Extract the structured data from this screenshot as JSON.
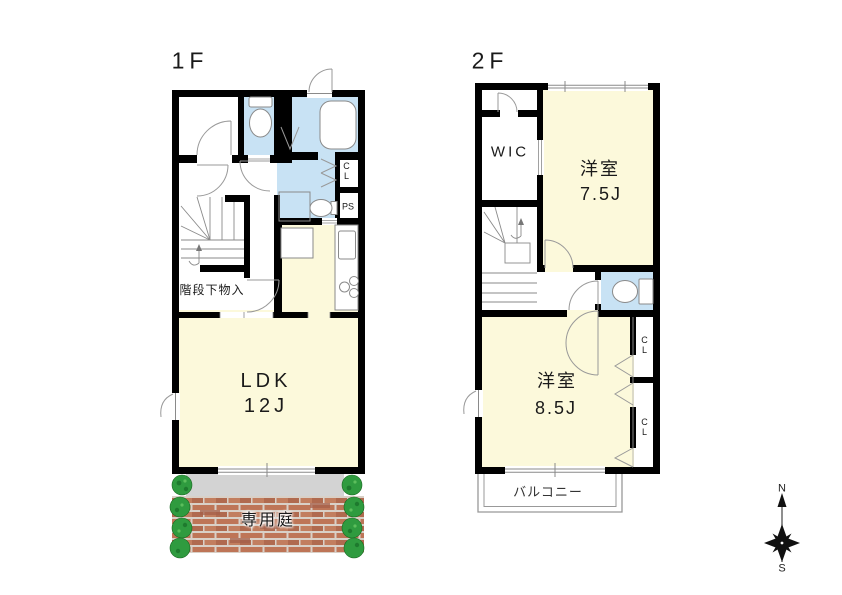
{
  "floor1": {
    "label": "1F",
    "ldk_name": "LDK",
    "ldk_size": "12J",
    "storage": "階段下物入",
    "closet": "CL",
    "pipe_space": "PS",
    "garden": "専用庭"
  },
  "floor2": {
    "label": "2F",
    "wic": "WIC",
    "bedroom1_name": "洋室",
    "bedroom1_size": "7.5J",
    "bedroom2_name": "洋室",
    "bedroom2_size": "8.5J",
    "closet1": "CL",
    "closet2": "CL",
    "balcony": "バルコニー"
  },
  "compass": {
    "north": "N",
    "south": "S"
  },
  "colors": {
    "wall": "#000000",
    "room_cream": "#FCF9DB",
    "wet_blue": "#C8E2F4",
    "terrace_gray": "#D3D3D3",
    "brick": "#BE7557",
    "brick_dark": "#A5604A",
    "mortar": "#D9D0C7",
    "bush_green": "#2F9B3F",
    "line_gray": "#8A8A8A"
  }
}
